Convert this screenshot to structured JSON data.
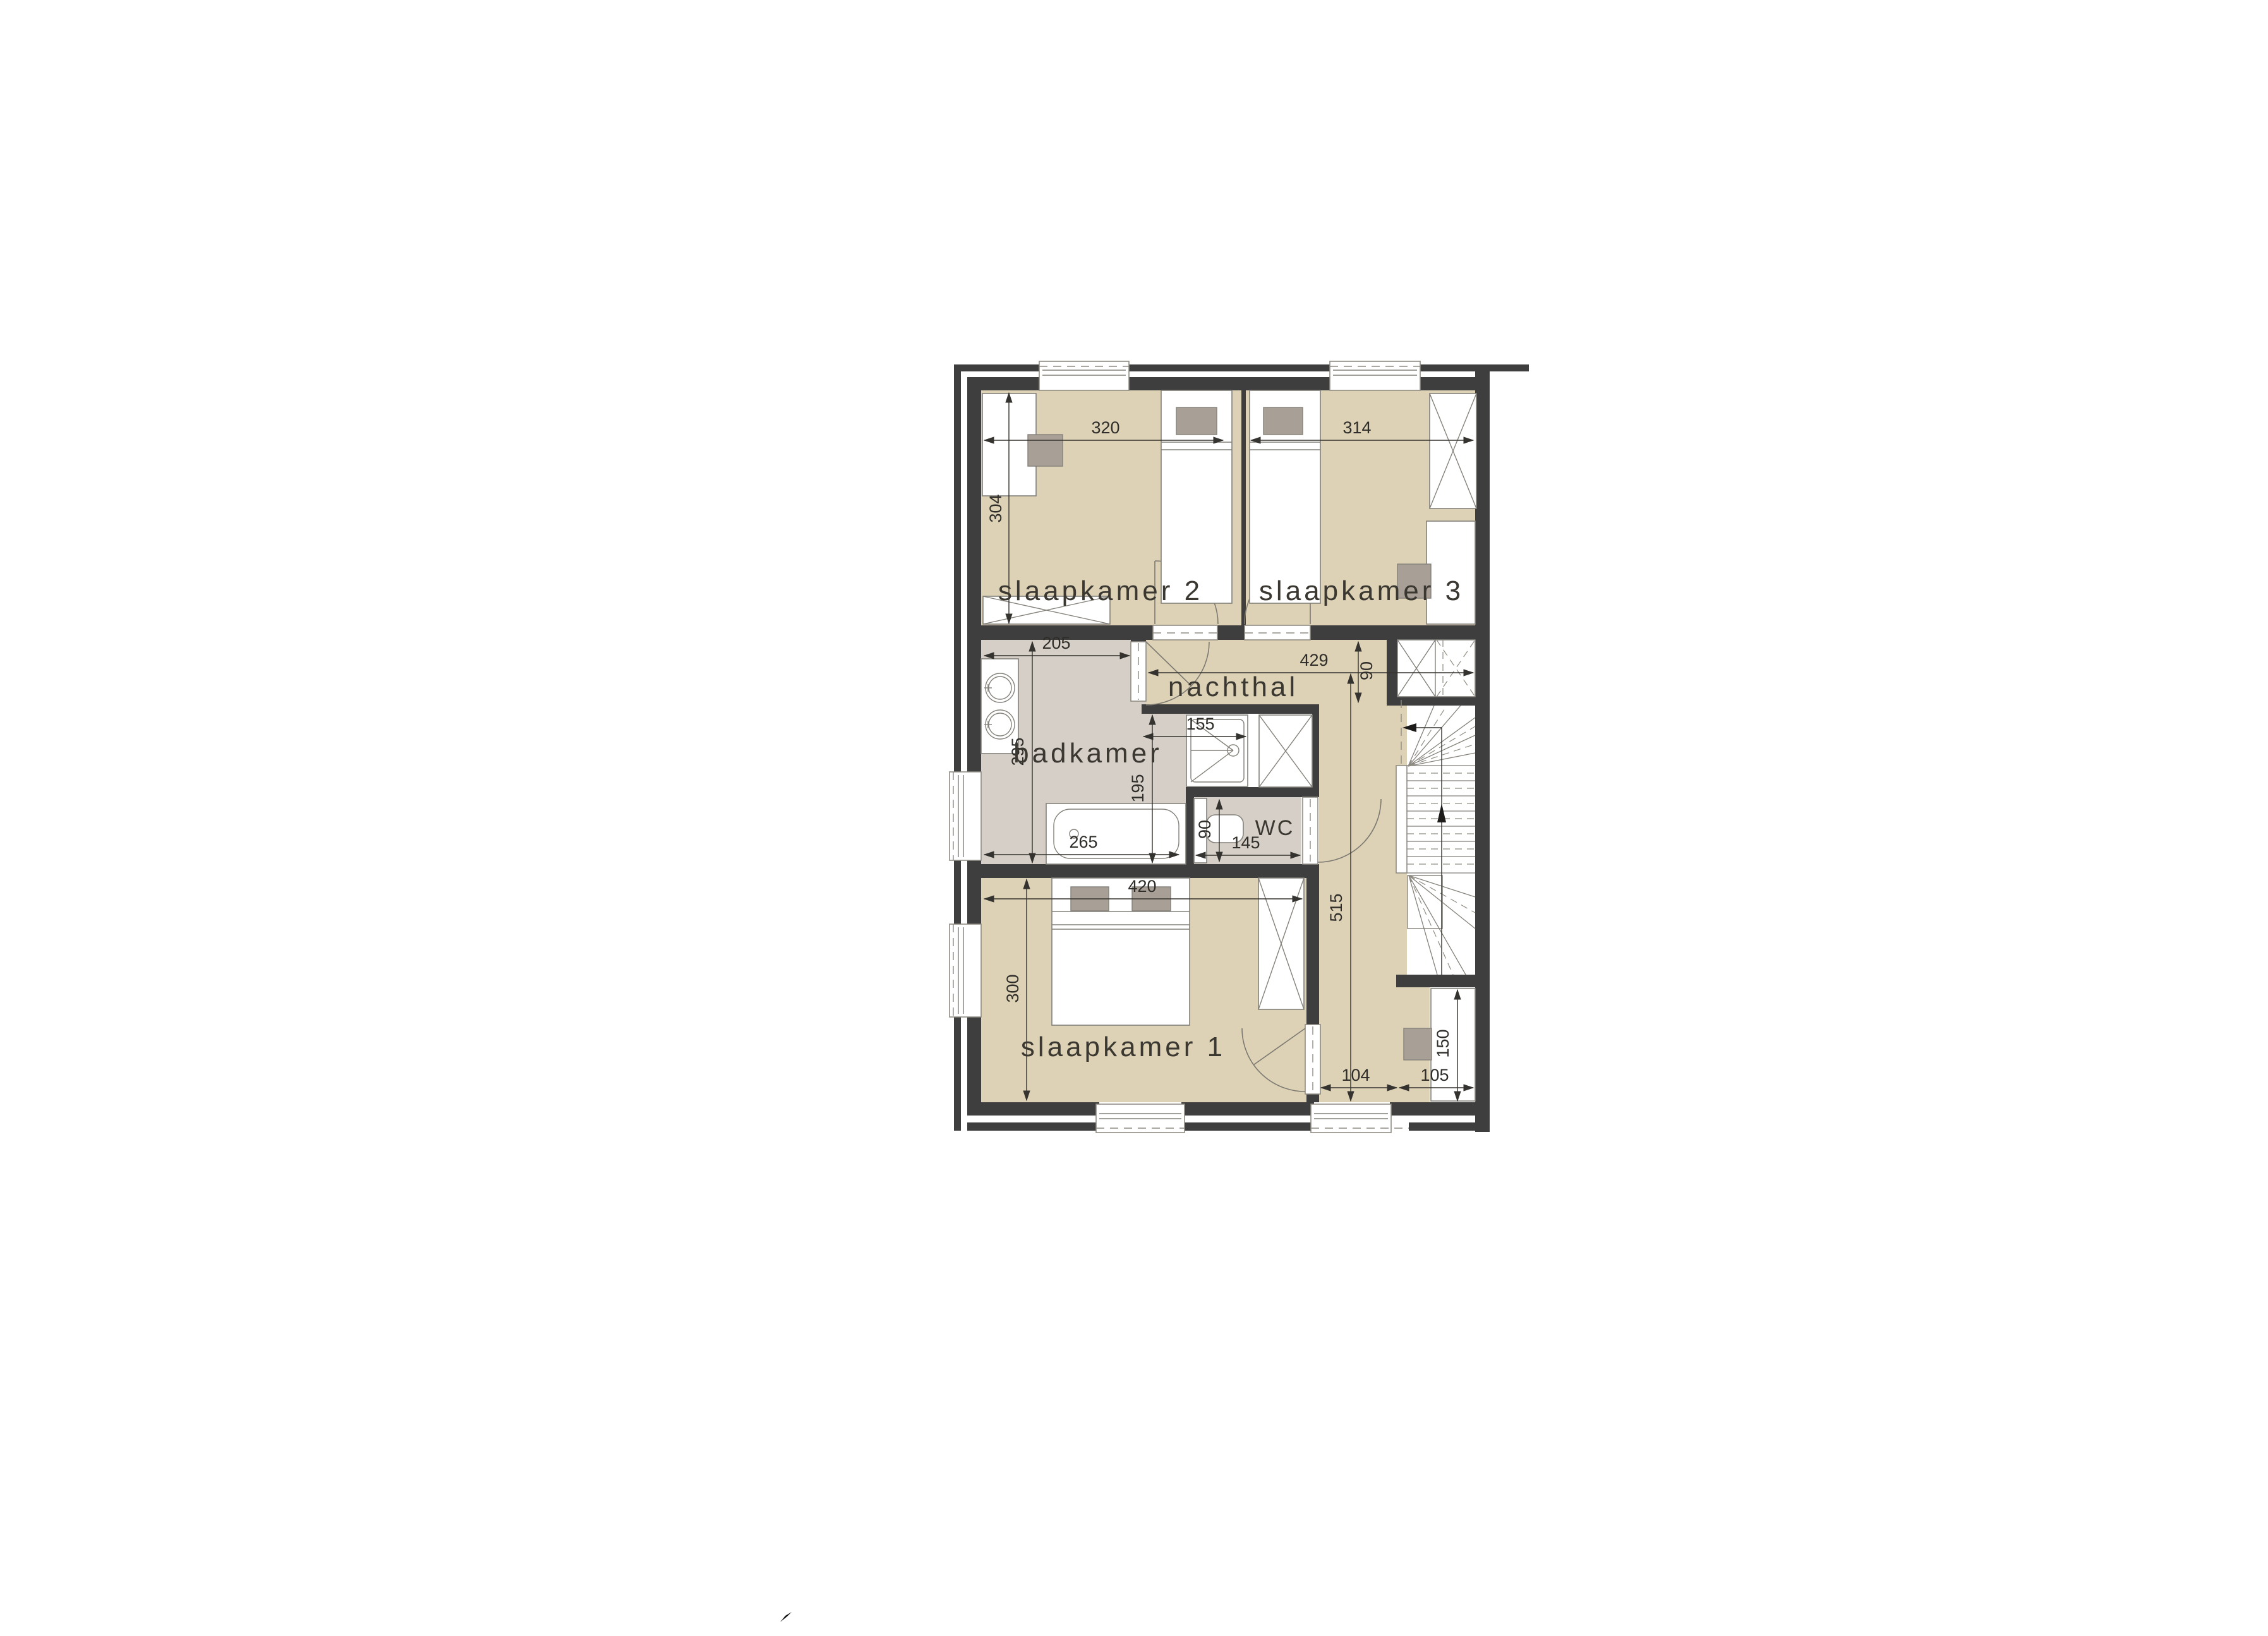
{
  "plan": {
    "title": "floor plan - upper storey",
    "rooms": {
      "bedroom2": "slaapkamer 2",
      "bedroom3": "slaapkamer 3",
      "hall": "nachthal",
      "bathroom": "badkamer",
      "wc": "WC",
      "bedroom1": "slaapkamer 1"
    },
    "dims": {
      "bedroom2_width": "320",
      "bedroom2_depth": "304",
      "bedroom3_width": "314",
      "bathroom_width": "205",
      "hall_width": "429",
      "hall_depth": "90",
      "shower_width": "155",
      "bathroom_depth": "295",
      "bath_zone_depth": "195",
      "bath_length": "265",
      "wc_depth": "90",
      "wc_width": "145",
      "bedroom1_width": "420",
      "bedroom1_depth": "300",
      "landing_length": "515",
      "landing_width": "104",
      "desk_zone_width": "105",
      "desk_length": "150"
    },
    "colors": {
      "wall": "#3e3e3e",
      "floor_rooms": "#ddd2b5",
      "floor_wet": "#d6cfc7",
      "furniture_grey": "#a89f97",
      "line": "#35332f"
    }
  }
}
